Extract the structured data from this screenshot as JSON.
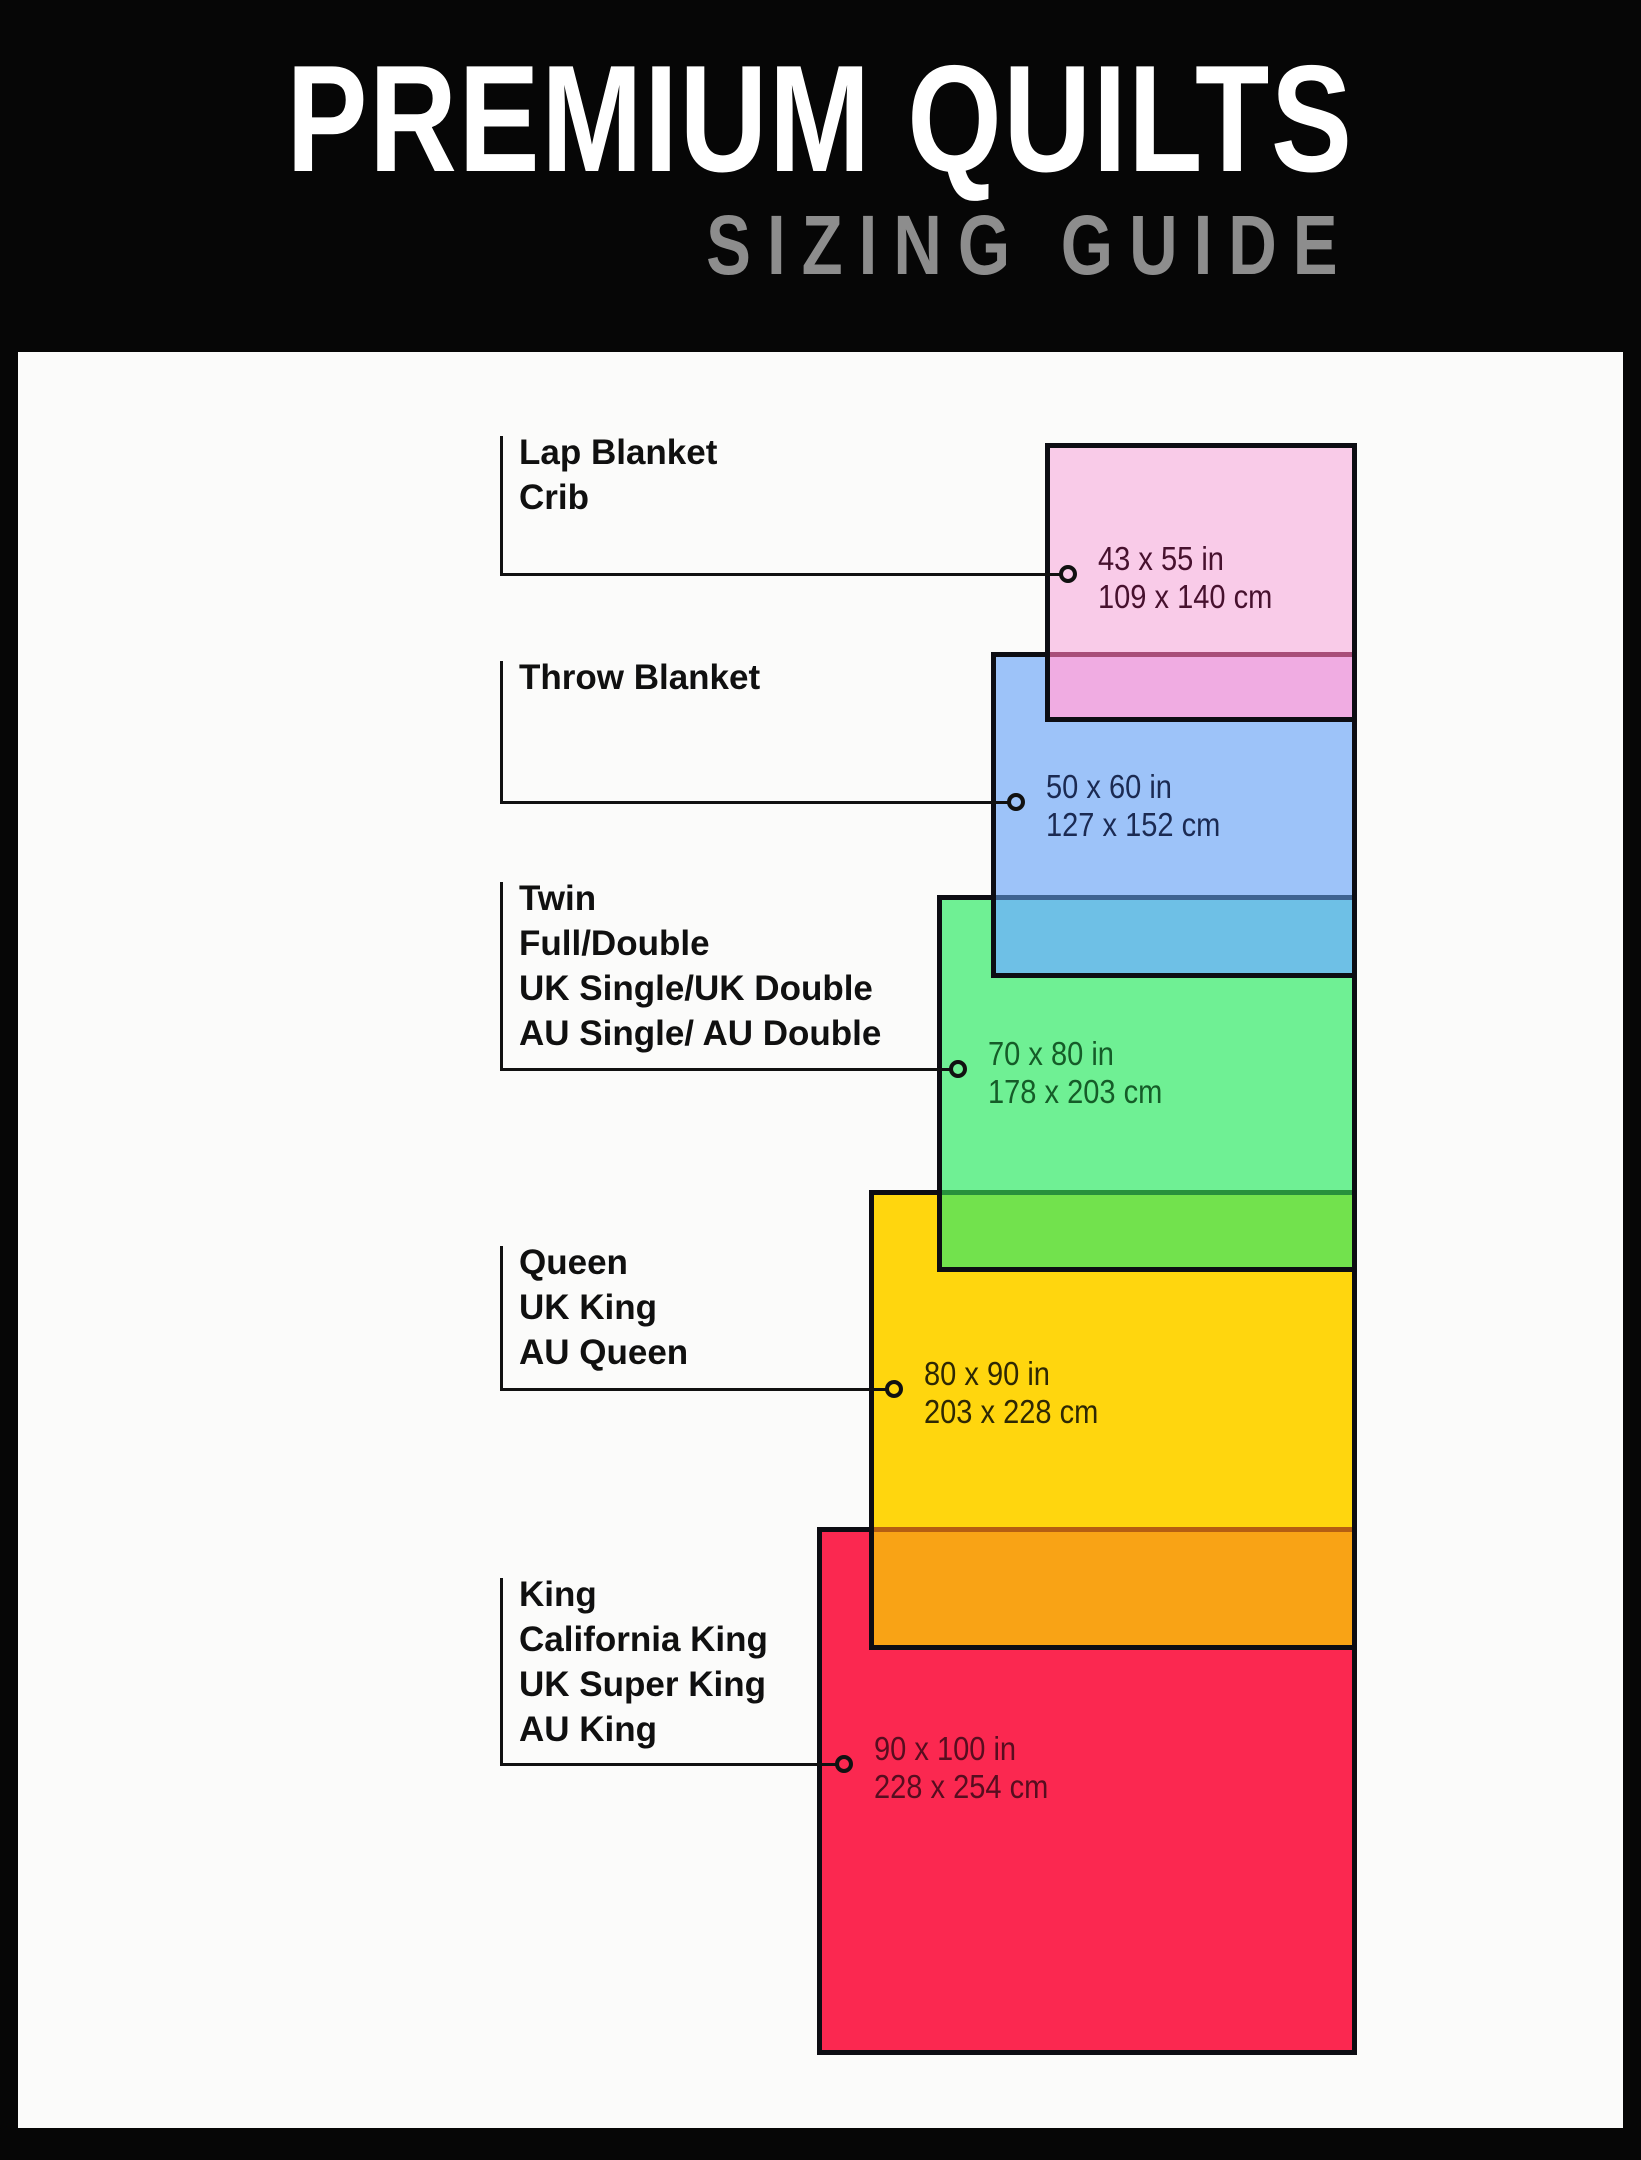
{
  "header": {
    "title": "PREMIUM QUILTS",
    "subtitle": "SIZING GUIDE",
    "bg_color": "#060606",
    "title_color": "#FFFFFF",
    "subtitle_color": "#8D8D8D"
  },
  "board": {
    "bg_color": "#FBFBFA",
    "frame_color": "#060606",
    "border_color": "#0D0D13",
    "leader_color": "#111111"
  },
  "sizes": [
    {
      "id": "lap-crib",
      "labels": [
        "Lap Blanket",
        "Crib"
      ],
      "size_in": "43 x 55 in",
      "size_cm": "109 x 140 cm",
      "fill": "#F9CBE8",
      "overlap_fill": "#F0ACE2",
      "overlap_line": "#A84E79",
      "text_color": "#47112E",
      "rect": {
        "left": 1045,
        "top": 443,
        "right": 1357,
        "bottom": 722
      },
      "overlap_top": 652,
      "ring": {
        "x": 1068,
        "y": 574
      },
      "label_top": 430
    },
    {
      "id": "throw",
      "labels": [
        "Throw Blanket"
      ],
      "size_in": "50 x 60 in",
      "size_cm": "127 x 152 cm",
      "fill": "#9DC3F9",
      "overlap_fill": "#6EC0E6",
      "overlap_line": "#3E6391",
      "text_color": "#1B2A52",
      "rect": {
        "left": 991,
        "top": 652,
        "right": 1357,
        "bottom": 978
      },
      "overlap_top": 895,
      "ring": {
        "x": 1016,
        "y": 802
      },
      "label_top": 655
    },
    {
      "id": "twin-full-double",
      "labels": [
        "Twin",
        "Full/Double",
        "UK Single/UK Double",
        "AU Single/ AU Double"
      ],
      "size_in": "70 x 80 in",
      "size_cm": "178 x 203 cm",
      "fill": "#6FF094",
      "overlap_fill": "#72E24D",
      "overlap_line": "#27913C",
      "text_color": "#155C28",
      "rect": {
        "left": 937,
        "top": 895,
        "right": 1357,
        "bottom": 1272
      },
      "overlap_top": 1190,
      "ring": {
        "x": 958,
        "y": 1069
      },
      "label_top": 876
    },
    {
      "id": "queen",
      "labels": [
        "Queen",
        "UK King",
        "AU Queen"
      ],
      "size_in": "80 x 90 in",
      "size_cm": "203 x 228 cm",
      "fill": "#FFD60E",
      "overlap_fill": "#F9A315",
      "overlap_line": "#B55E12",
      "text_color": "#2E2804",
      "rect": {
        "left": 869,
        "top": 1190,
        "right": 1357,
        "bottom": 1650
      },
      "overlap_top": 1527,
      "ring": {
        "x": 894,
        "y": 1389
      },
      "label_top": 1240
    },
    {
      "id": "king",
      "labels": [
        "King",
        "California King",
        "UK Super King",
        "AU King"
      ],
      "size_in": "90 x 100 in",
      "size_cm": "228 x 254 cm",
      "fill": "#FB2850",
      "overlap_fill": null,
      "overlap_line": null,
      "text_color": "#570D1F",
      "rect": {
        "left": 817,
        "top": 1527,
        "right": 1357,
        "bottom": 2055
      },
      "overlap_top": null,
      "ring": {
        "x": 844,
        "y": 1764
      },
      "label_top": 1572
    }
  ]
}
